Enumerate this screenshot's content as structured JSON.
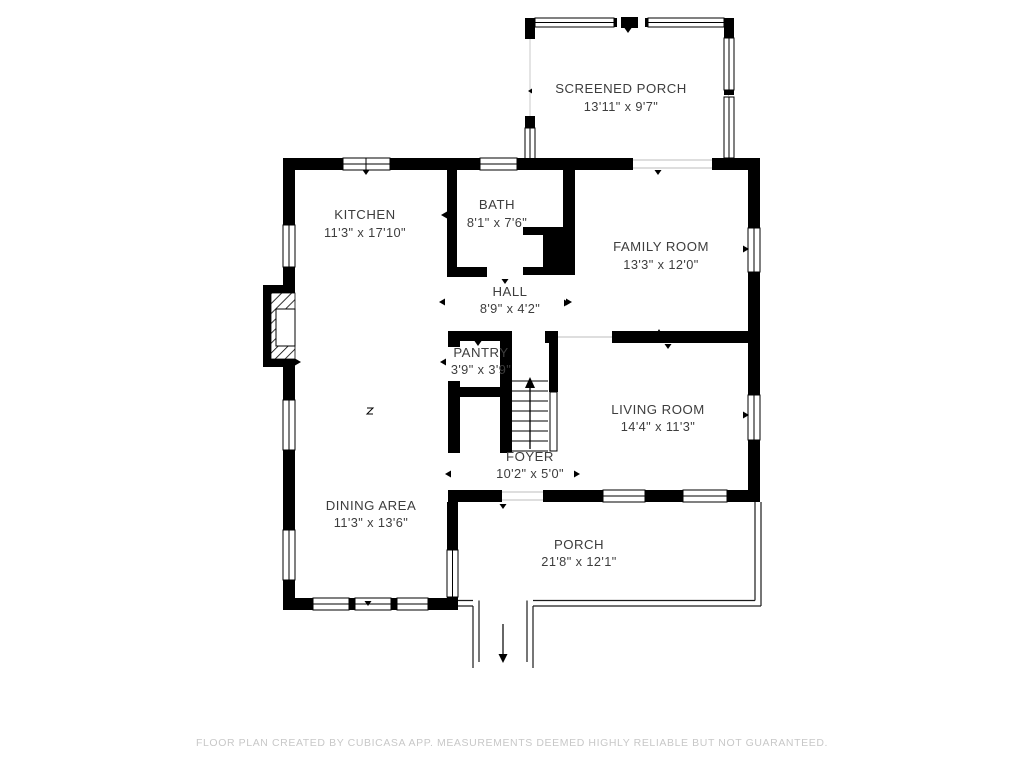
{
  "colors": {
    "wall": "#000000",
    "label": "#3d3d3d",
    "footer": "#c8c8c8",
    "background": "#ffffff"
  },
  "rooms": [
    {
      "name": "SCREENED PORCH",
      "dims": "13'11\" x 9'7\""
    },
    {
      "name": "KITCHEN",
      "dims": "11'3\" x 17'10\""
    },
    {
      "name": "BATH",
      "dims": "8'1\" x 7'6\""
    },
    {
      "name": "FAMILY ROOM",
      "dims": "13'3\" x 12'0\""
    },
    {
      "name": "HALL",
      "dims": "8'9\" x 4'2\""
    },
    {
      "name": "PANTRY",
      "dims": "3'9\" x 3'9\""
    },
    {
      "name": "LIVING ROOM",
      "dims": "14'4\" x 11'3\""
    },
    {
      "name": "FOYER",
      "dims": "10'2\" x 5'0\""
    },
    {
      "name": "DINING AREA",
      "dims": "11'3\" x 13'6\""
    },
    {
      "name": "PORCH",
      "dims": "21'8\" x 12'1\""
    }
  ],
  "footer": {
    "disclaimer": "FLOOR PLAN CREATED BY CUBICASA APP. MEASUREMENTS DEEMED HIGHLY RELIABLE BUT NOT GUARANTEED."
  }
}
